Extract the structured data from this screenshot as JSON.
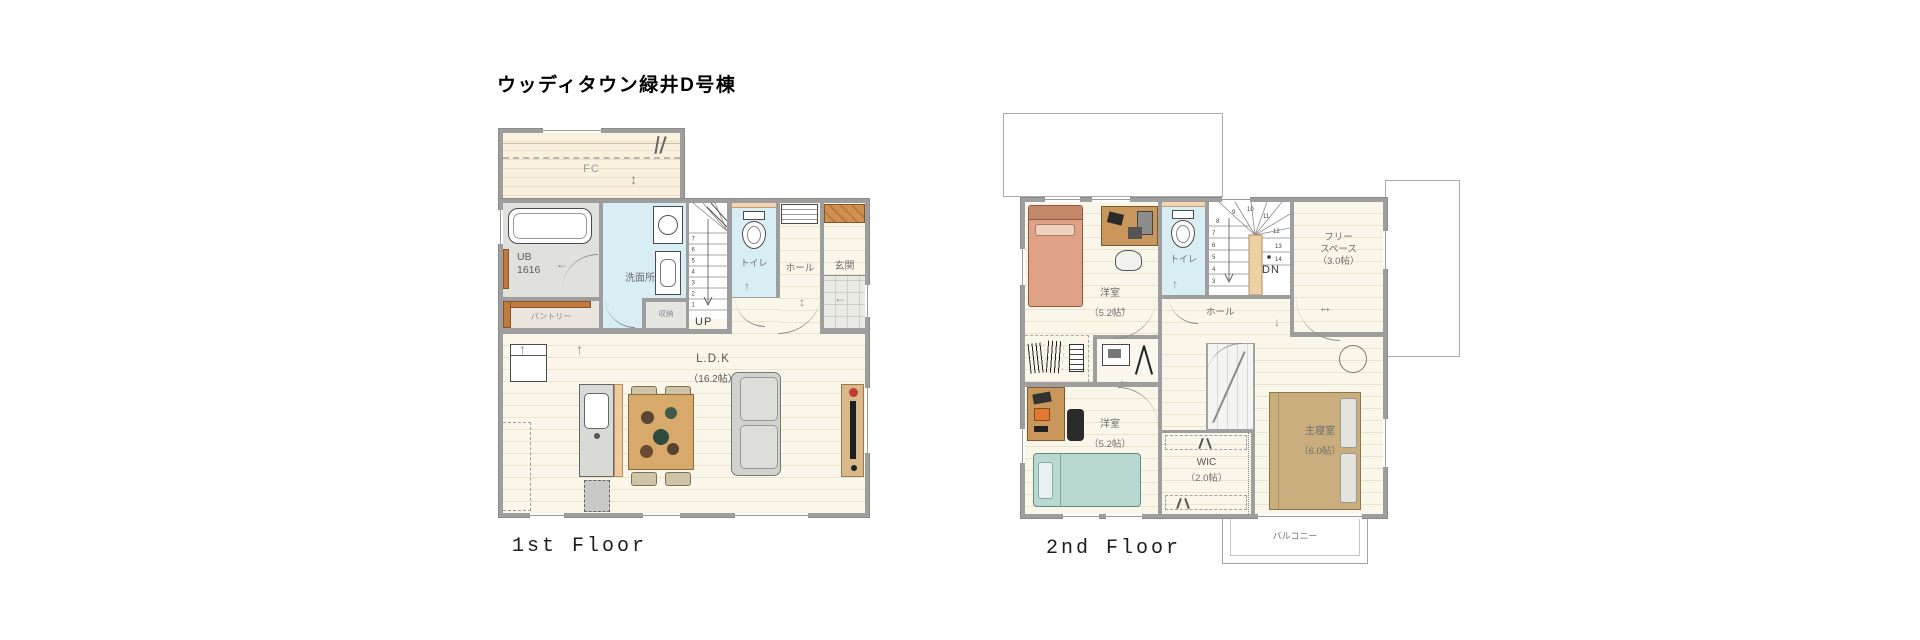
{
  "title": "ウッディタウン緑井D号棟",
  "floor1": {
    "caption": "1st Floor",
    "labels": {
      "fc": "FC",
      "ub": "UB",
      "ub_size": "1616",
      "washroom": "洗面所",
      "pantry": "パントリー",
      "storage": "収納",
      "up": "UP",
      "toilet": "トイレ",
      "hall": "ホール",
      "entrance": "玄関",
      "ldk": "L.D.K",
      "ldk_size": "（16.2帖）"
    },
    "stair_numbers": [
      "7",
      "6",
      "5",
      "4",
      "3",
      "2",
      "1"
    ]
  },
  "floor2": {
    "caption": "2nd Floor",
    "labels": {
      "bedroom1": "洋室",
      "bedroom1_size": "（5.2帖）",
      "toilet": "トイレ",
      "dn": "DN",
      "free_line1": "フリー",
      "free_line2": "スペース",
      "free_size": "（3.0帖）",
      "hall": "ホール",
      "bedroom2": "洋室",
      "bedroom2_size": "（5.2帖）",
      "master": "主寝室",
      "master_size": "（6.0帖）",
      "wic": "WIC",
      "wic_size": "（2.0帖）",
      "balcony": "バルコニー"
    },
    "stair_numbers_left": [
      "8",
      "7",
      "6",
      "5",
      "4",
      "3"
    ],
    "stair_numbers_top": [
      "9",
      "10",
      "11"
    ],
    "stair_numbers_right": [
      "12",
      "13",
      "14"
    ]
  },
  "arrows": {
    "left": "←",
    "right": "→",
    "up": "↑",
    "down": "↓",
    "h": "↔",
    "v": "↕"
  },
  "colors": {
    "wall": "#9e9e9e",
    "floor": "#fbf6ea",
    "wet_floor": "#d9edf5",
    "wood_accent": "#c07a3e",
    "stair_core": "#eed0a5",
    "bed_salmon": "#dfa287",
    "bed_teal": "#b7d9d1",
    "bed_master": "#c9ad7c"
  }
}
